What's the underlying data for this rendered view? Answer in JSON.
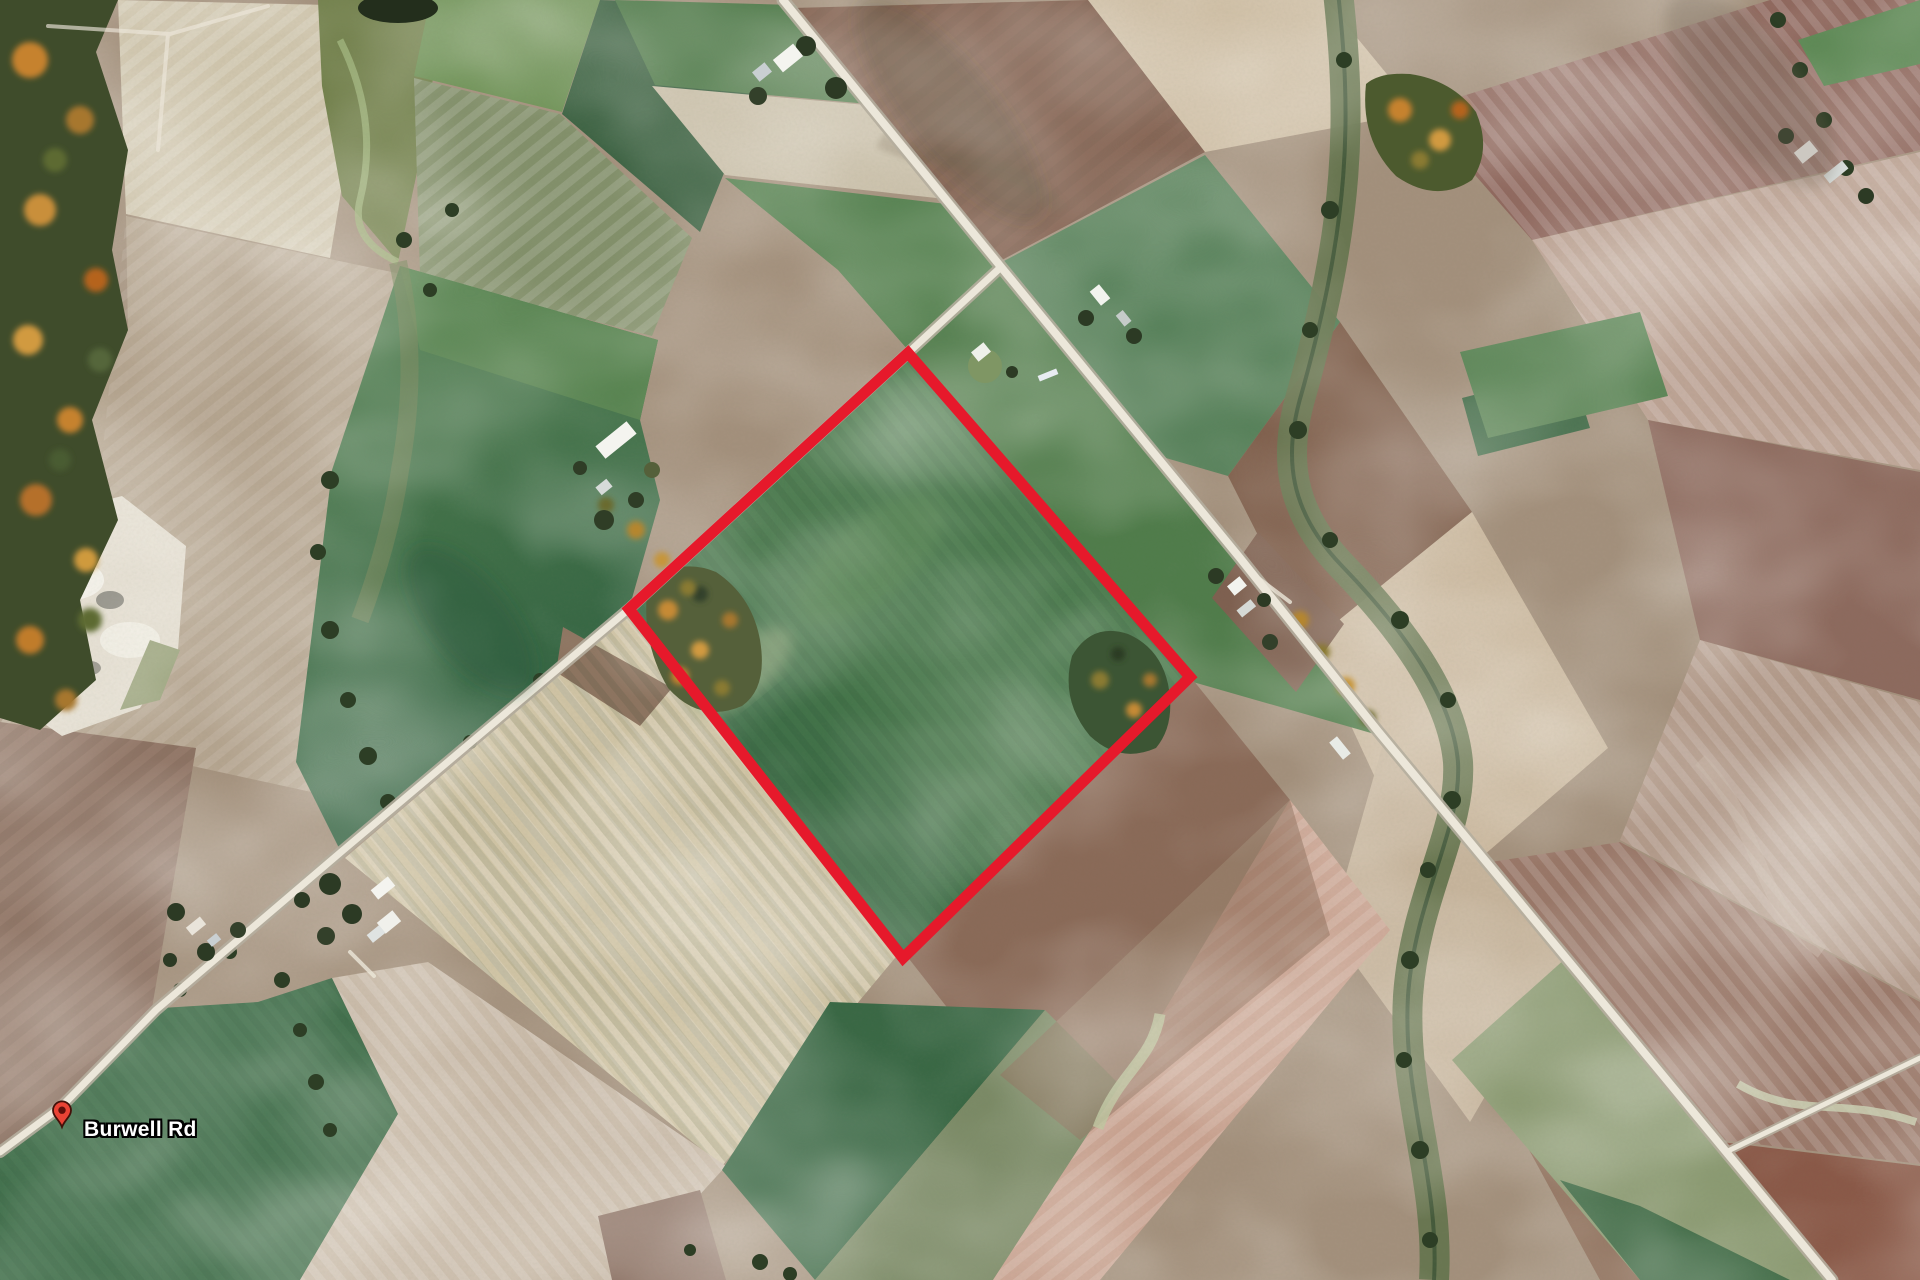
{
  "map": {
    "view": "satellite",
    "pin": {
      "label": "Burwell Rd",
      "color": "#EA4335",
      "x": 62,
      "y": 1127
    },
    "property_boundary": {
      "points": "908,353 1190,677 903,958 629,609",
      "color": "#E6192B",
      "stroke_width": 11
    },
    "palette": {
      "field_green_dark": "#2f6041",
      "field_green": "#4a7a4c",
      "field_sage": "#83906b",
      "field_brown": "#7f5c4b",
      "field_mauve": "#90695f",
      "field_tan": "#cfc0a8",
      "road": "#ece7da",
      "forest": "#3f4c2b",
      "autumn_orange": "#c6822f",
      "quarry_white": "#e3ddd0"
    }
  }
}
